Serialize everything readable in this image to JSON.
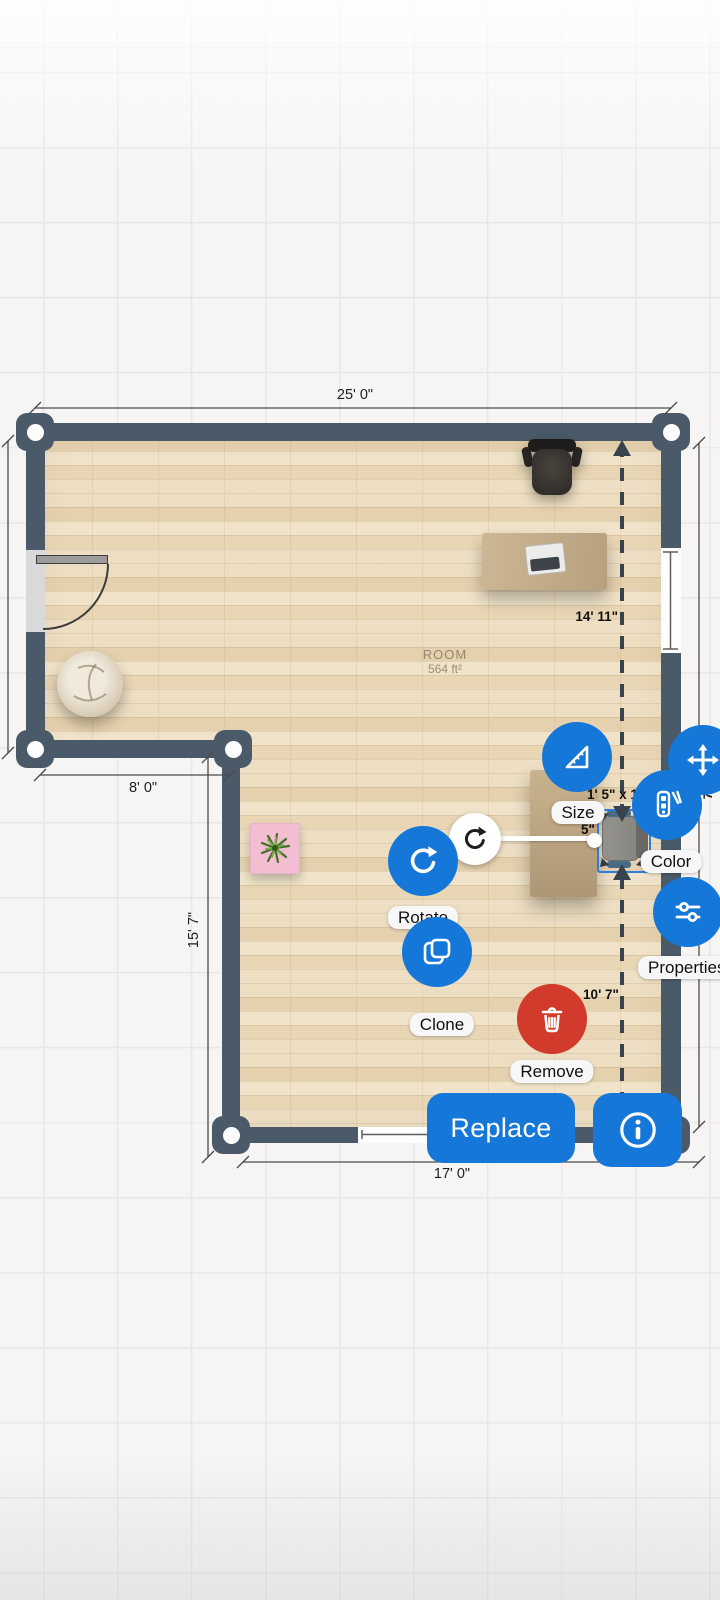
{
  "room": {
    "name": "ROOM",
    "area": "564 ft²"
  },
  "dimensions": {
    "top_width": "25' 0\"",
    "upper_left_width": "8' 0\"",
    "lower_left_height": "15' 7\"",
    "bottom_width": "17' 0\"",
    "object_to_top_wall": "14' 11\"",
    "object_to_bottom_wall": "10' 7\"",
    "selected_object_size": "1' 5\" x 1",
    "selected_object_offset": "5\"",
    "right_wall_fragment": "7\""
  },
  "selection_menu": {
    "size": "Size",
    "rotate": "Rotate",
    "clone": "Clone",
    "remove": "Remove",
    "color": "Color",
    "properties": "Properties",
    "replace": "Replace"
  },
  "icons": {
    "size": "set-square-ruler",
    "rotate": "rotate-arrow",
    "clone": "copy-pages",
    "remove": "trash-can",
    "color": "paint-swatch-pen",
    "properties": "sliders",
    "move": "four-way-arrows",
    "info": "info-circle",
    "rotate_handle": "rotate-arrow-small"
  },
  "colors": {
    "accent_blue": "#1577d8",
    "danger_red": "#d23a2b",
    "wall": "#4b5a68",
    "selection_blue": "#2d7fd8",
    "floor_base": "#ead8b8",
    "pink_table": "#f3bdd2",
    "pill_bg": "#f7f7f8"
  }
}
